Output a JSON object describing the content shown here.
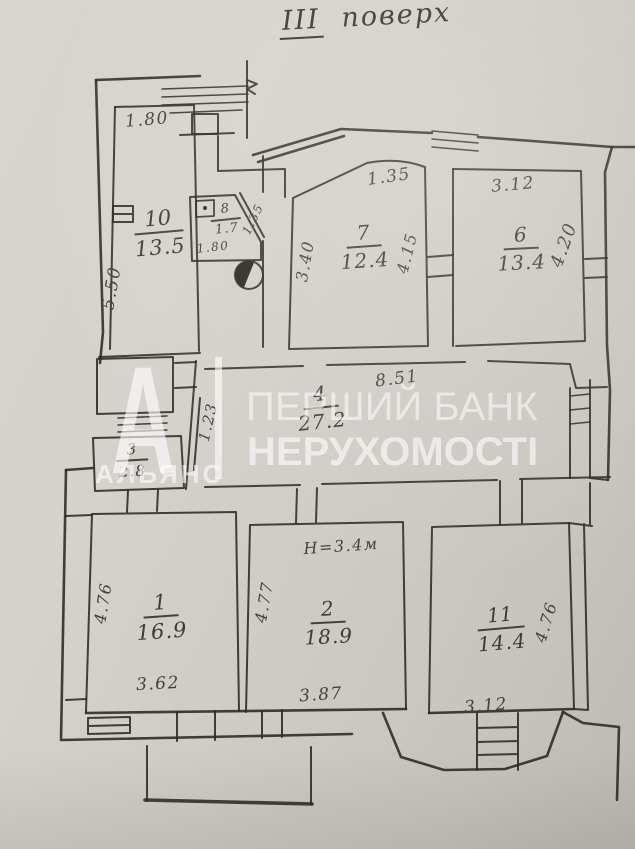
{
  "title": {
    "roman": "III",
    "word": "поверх"
  },
  "watermark": {
    "logo_letter": "А",
    "agency_name": "АЛЬЯНС",
    "bank_line1": "ПЕРШИЙ БАНК",
    "bank_line2": "НЕРУХОМОСТІ"
  },
  "rooms": {
    "r1": {
      "number": "1",
      "area": "16.9"
    },
    "r2": {
      "number": "2",
      "area": "18.9"
    },
    "r3": {
      "number": "3",
      "area": "2.8"
    },
    "r4": {
      "number": "4",
      "area": "27.2"
    },
    "r6": {
      "number": "6",
      "area": "13.4"
    },
    "r7": {
      "number": "7",
      "area": "12.4"
    },
    "r8": {
      "number": "8",
      "area": "1.7"
    },
    "r10": {
      "number": "10",
      "area": "13.5"
    },
    "r11": {
      "number": "11",
      "area": "14.4"
    }
  },
  "dims": {
    "room10_top": "1.80",
    "room10_left": "5.50",
    "room8_bottom": "1.80",
    "room8_diagonal": "1.35",
    "room7_top": "1.35",
    "room7_left": "3.40",
    "room7_right": "4.15",
    "room6_top": "3.12",
    "room6_right": "4.20",
    "hall_top": "8.51",
    "hall_left": "1.23",
    "ceiling_height": "H=3.4м",
    "room1_left": "4.76",
    "room1_bottom": "3.62",
    "room2_left": "4.77",
    "room2_bottom": "3.87",
    "room11_right": "4.76",
    "room11_bottom": "3.12"
  },
  "line_color": "#2b2823",
  "paper_color": "#cfcbc5"
}
